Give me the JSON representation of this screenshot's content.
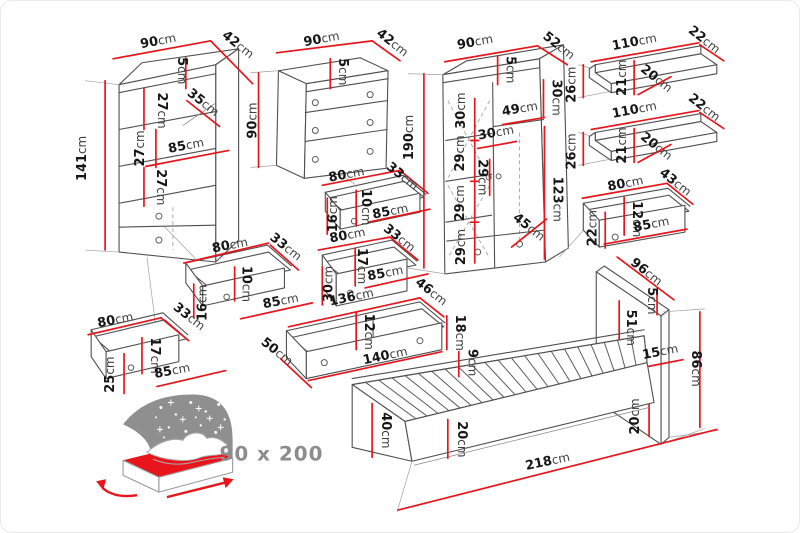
{
  "colors": {
    "dimension_red": "#e8151c",
    "outline_gray": "#4f4f4f",
    "label_number": "#161616",
    "label_unit": "#3f3f3f",
    "caption_gray": "#8c8c8c",
    "star_backdrop_gray": "#8f8f8f",
    "mattress_red": "#e8151c"
  },
  "unit": "cm",
  "caption": {
    "bed_size": "90 x 200"
  },
  "pieces": [
    {
      "id": "bookshelf",
      "labels": [
        [
          "90",
          158,
          44,
          -11
        ],
        [
          "42",
          235,
          47,
          38
        ],
        [
          "141",
          85,
          158,
          -90
        ],
        [
          "5",
          177,
          70,
          90
        ],
        [
          "27",
          157,
          110,
          90
        ],
        [
          "35",
          200,
          105,
          38
        ],
        [
          "27",
          143,
          148,
          -90
        ],
        [
          "85",
          186,
          149,
          -11
        ],
        [
          "27",
          156,
          187,
          90
        ]
      ]
    },
    {
      "id": "dresser",
      "labels": [
        [
          "90",
          322,
          42,
          -11
        ],
        [
          "42",
          390,
          45,
          38
        ],
        [
          "90",
          256,
          120,
          -90
        ],
        [
          "5",
          339,
          71,
          90
        ]
      ]
    },
    {
      "id": "wardrobe",
      "labels": [
        [
          "90",
          476,
          45,
          -11
        ],
        [
          "52",
          557,
          48,
          38
        ],
        [
          "190",
          413,
          137,
          -90
        ],
        [
          "5",
          507,
          69,
          90
        ],
        [
          "30",
          553,
          97,
          90
        ],
        [
          "49",
          521,
          112,
          -10
        ],
        [
          "30",
          465,
          110,
          -90
        ],
        [
          "30",
          497,
          136,
          -10
        ],
        [
          "29",
          464,
          153,
          -90
        ],
        [
          "29",
          479,
          177,
          90
        ],
        [
          "29",
          464,
          203,
          -90
        ],
        [
          "29",
          465,
          247,
          -90
        ],
        [
          "123",
          554,
          199,
          90
        ],
        [
          "45",
          527,
          230,
          38
        ]
      ]
    },
    {
      "id": "wall-shelf-upper",
      "labels": [
        [
          "110",
          636,
          45,
          -11
        ],
        [
          "22",
          703,
          42,
          38
        ],
        [
          "26",
          576,
          84,
          -90
        ],
        [
          "21",
          627,
          77,
          -90
        ],
        [
          "20",
          655,
          81,
          38
        ]
      ]
    },
    {
      "id": "wall-shelf-lower",
      "labels": [
        [
          "110",
          636,
          113,
          -11
        ],
        [
          "22",
          703,
          110,
          38
        ],
        [
          "26",
          576,
          151,
          -90
        ],
        [
          "21",
          627,
          145,
          -90
        ],
        [
          "20",
          655,
          149,
          38
        ]
      ]
    },
    {
      "id": "wardrobe-drawer",
      "labels": [
        [
          "80",
          627,
          187,
          -11
        ],
        [
          "43",
          674,
          185,
          38
        ],
        [
          "12",
          634,
          219,
          90
        ],
        [
          "22",
          597,
          228,
          -90
        ],
        [
          "85",
          653,
          228,
          -11
        ]
      ]
    },
    {
      "id": "dresser-drawer-upper",
      "labels": [
        [
          "80",
          347,
          178,
          -11
        ],
        [
          "33",
          400,
          179,
          38
        ],
        [
          "10",
          362,
          207,
          90
        ],
        [
          "16",
          337,
          214,
          -90
        ],
        [
          "85",
          391,
          215,
          -11
        ]
      ]
    },
    {
      "id": "dresser-drawer-lower",
      "labels": [
        [
          "80",
          348,
          239,
          -11
        ],
        [
          "33",
          397,
          241,
          38
        ],
        [
          "17",
          358,
          266,
          90
        ],
        [
          "30",
          332,
          284,
          -90
        ],
        [
          "85",
          386,
          277,
          -11
        ]
      ]
    },
    {
      "id": "bookshelf-drawer-small",
      "labels": [
        [
          "80",
          230,
          249,
          -11
        ],
        [
          "33",
          283,
          250,
          38
        ],
        [
          "10",
          242,
          284,
          90
        ],
        [
          "16",
          206,
          303,
          -90
        ],
        [
          "85",
          281,
          305,
          -11
        ]
      ]
    },
    {
      "id": "bookshelf-drawer-large",
      "labels": [
        [
          "80",
          115,
          324,
          -11
        ],
        [
          "33",
          186,
          320,
          38
        ],
        [
          "17",
          150,
          356,
          90
        ],
        [
          "25",
          113,
          375,
          -90
        ],
        [
          "85",
          172,
          375,
          -11
        ]
      ]
    },
    {
      "id": "bed-drawer",
      "labels": [
        [
          "136",
          352,
          301,
          -12
        ],
        [
          "46",
          429,
          295,
          38
        ],
        [
          "12",
          365,
          332,
          90
        ],
        [
          "18",
          456,
          333,
          90
        ],
        [
          "140",
          386,
          360,
          -12
        ],
        [
          "50",
          274,
          355,
          38
        ]
      ]
    },
    {
      "id": "bed",
      "labels": [
        [
          "9",
          469,
          363,
          90
        ],
        [
          "40",
          382,
          431,
          90
        ],
        [
          "20",
          458,
          440,
          90
        ],
        [
          "218",
          549,
          466,
          -12
        ]
      ]
    },
    {
      "id": "headboard",
      "labels": [
        [
          "96",
          645,
          275,
          38
        ],
        [
          "5",
          649,
          301,
          90
        ],
        [
          "51",
          628,
          328,
          90
        ],
        [
          "15",
          662,
          356,
          -11
        ],
        [
          "86",
          693,
          369,
          90
        ],
        [
          "20",
          640,
          417,
          -90
        ]
      ]
    }
  ]
}
